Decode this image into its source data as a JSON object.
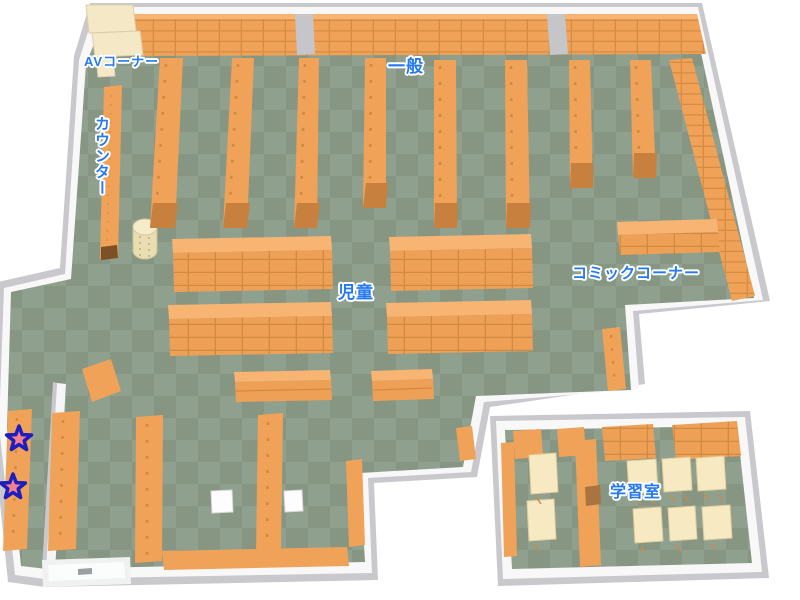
{
  "map": {
    "labels": {
      "av_corner": "AVコーナー",
      "counter": "カウンター",
      "general": "一般",
      "children": "児童",
      "comic_corner": "コミックコーナー",
      "study_room": "学習室"
    },
    "markers": {
      "star_count": 2
    },
    "colors": {
      "floor_light": "#90a08e",
      "floor_dark": "#869683",
      "shelf_orange": "#efa258",
      "shelf_top_light": "#f7b472",
      "shelf_line": "#d68c42",
      "shelf_base": "#c8803e",
      "wall_white": "#f8f8f9",
      "wall_gray": "#c9c9cd",
      "cream_shelf": "#f4e8c6",
      "table_cream": "#f7e9c2",
      "label_blue": "#2479f2",
      "star_pink": "#f4808e",
      "star_border": "#1d1dc0"
    }
  }
}
